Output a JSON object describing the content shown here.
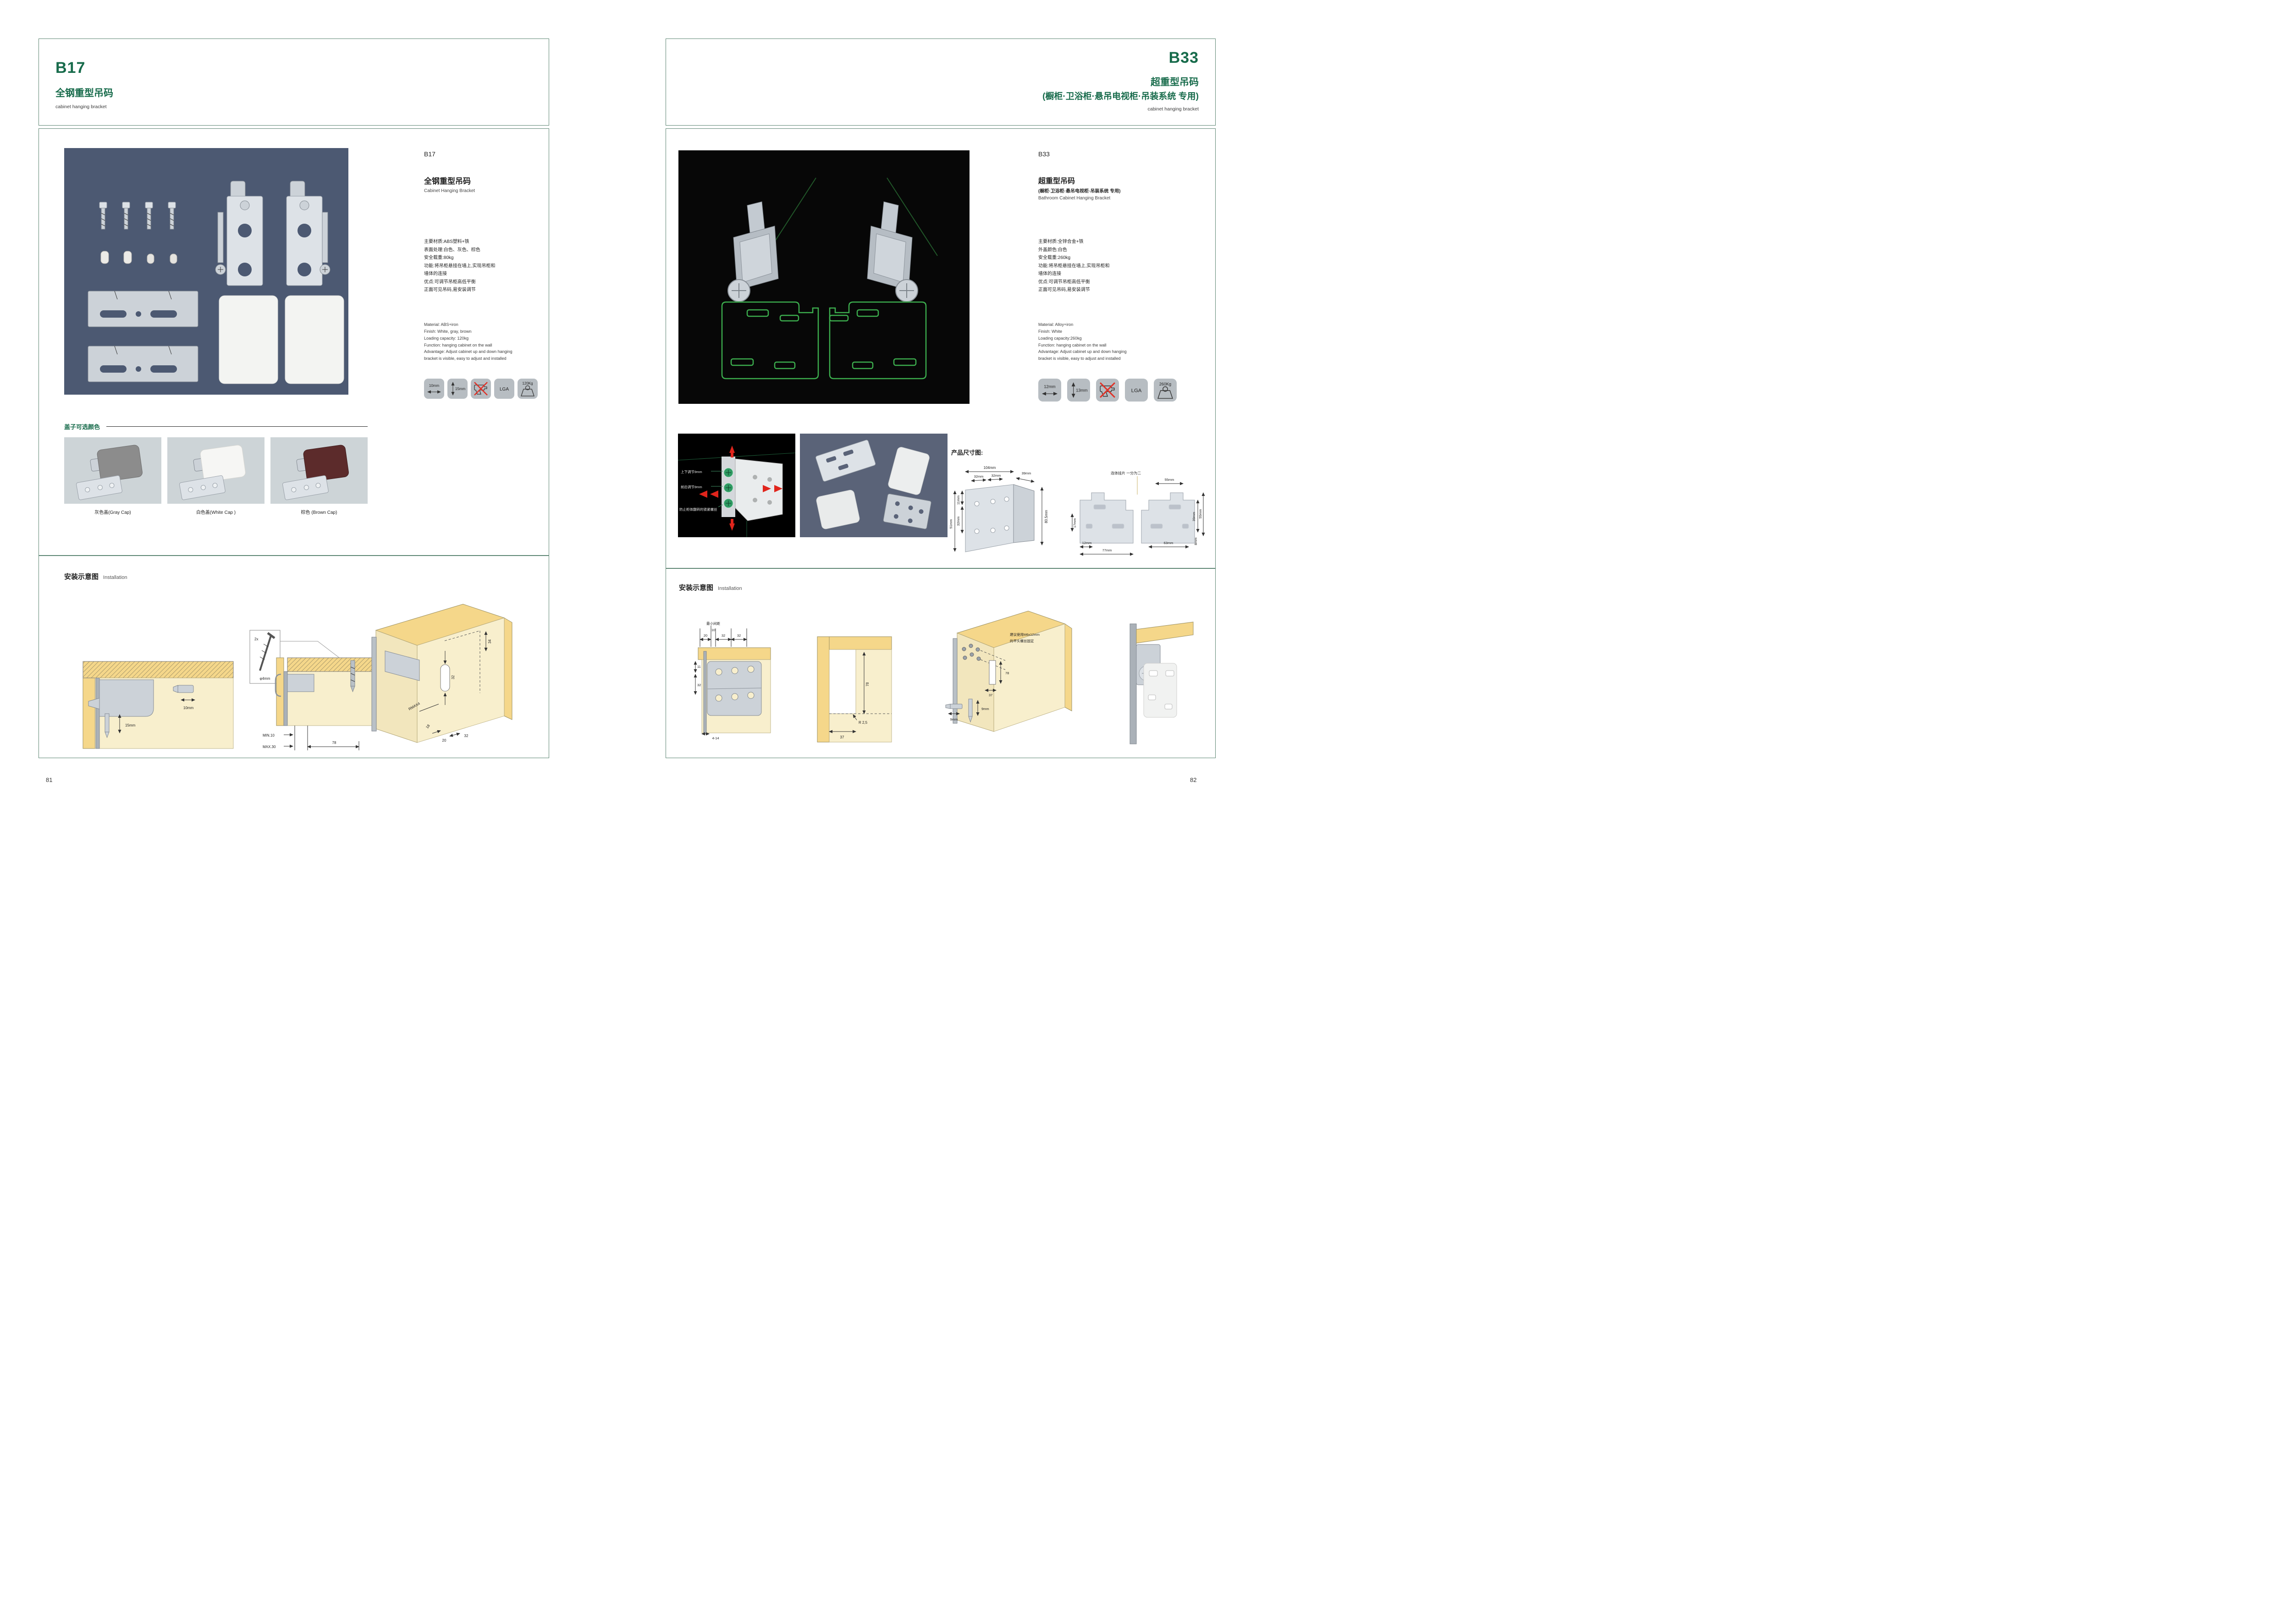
{
  "pages": {
    "left": {
      "page_number": "81",
      "header": {
        "code": "B17",
        "title_cn": "全钢重型吊码",
        "subtitle_en": "cabinet hanging bracket"
      },
      "product": {
        "code": "B17",
        "title_cn": "全钢重型吊码",
        "title_en": "Cabinet Hanging Bracket",
        "specs_cn": [
          "主要材质:ABS塑料+铁",
          "表面处理:白色、灰色、棕色",
          "安全载重:80kg",
          "功能:将吊柜悬挂在墙上,实现吊柜和",
          "墙体的连接",
          "优点:可调节吊柜高低平衡",
          "正面可见吊码,易安装调节"
        ],
        "specs_en": [
          "Material: ABS+iron",
          "Finish: White, gray, brown",
          "Loading capacity: 120kg",
          "Function: hanging cabinet on the wall",
          "Advantage: Adjust cabinet up and down hanging",
          "bracket is visible, easy to adjust and installed"
        ],
        "icons": {
          "width": "10mm",
          "height": "15mm",
          "no_drill": "no-drill-icon",
          "cert": "LGA",
          "load": "120Kg"
        }
      },
      "caps": {
        "section_title": "盖子可选颜色",
        "items": [
          {
            "label": "灰色盖(Gray Cap)"
          },
          {
            "label": "白色盖(White Cap )"
          },
          {
            "label": "棕色 (Brown Cap)"
          }
        ]
      },
      "installation": {
        "title_cn": "安装示意图",
        "title_en": "Installation",
        "d1": {
          "dim_w": "10mm",
          "dim_h": "15mm"
        },
        "d2": {
          "qty": "2x",
          "dia": "φ4mm",
          "t": "13",
          "min": "MIN.10",
          "max": "MAX.30",
          "depth": "78"
        },
        "d3": {
          "a": "34",
          "b": "32",
          "r": "RMAX4",
          "c": "18",
          "d": "20",
          "e": "32"
        }
      }
    },
    "right": {
      "page_number": "82",
      "header": {
        "code": "B33",
        "title_cn": "超重型吊码",
        "subtitle_cn": "(橱柜·卫浴柜·悬吊电视柜·吊装系统 专用)",
        "subtitle_en": "cabinet hanging bracket"
      },
      "product": {
        "code": "B33",
        "title_cn": "超重型吊码",
        "subtitle_cn": "(橱柜·卫浴柜·悬吊电视柜·吊装系统 专用)",
        "title_en": "Bathroom Cabinet Hanging Bracket",
        "specs_cn": [
          "主要材质:全锌合金+铁",
          "外盖颜色:白色",
          "安全载重:260kg",
          "功能:将吊柜悬挂在墙上,实现吊柜和",
          "墙体的连接",
          "优点:可调节吊柜高低平衡",
          "正面可见吊码,易安装调节"
        ],
        "specs_en": [
          "Material: Alloy+iron",
          "Finish: White",
          "Loading capacity:260kg",
          "Function: hanging cabinet on the wall",
          "Advantage: Adjust cabinet up and down hanging",
          "bracket is visible, easy to adjust and installed"
        ],
        "icons": {
          "width": "12mm",
          "height": "13mm",
          "no_drill": "no-drill-icon",
          "cert": "LGA",
          "load": "260Kg"
        }
      },
      "features": {
        "ann1": "上下调节9mm",
        "ann2": "前后调节9mm",
        "ann3": "防止柜体翻转的锁紧螺丝"
      },
      "dims": {
        "title": "产品尺寸图:",
        "bracket": {
          "w": "104mm",
          "p1": "32mm",
          "p2": "32mm",
          "d": "39mm",
          "e1": "11mm",
          "e2": "32mm",
          "e3": "51mm",
          "h": "80.5mm"
        },
        "plate": {
          "note": "连体挂片 一分为二",
          "top": "55mm",
          "left": "17mm",
          "b1": "12mm",
          "b2": "77mm",
          "b3": "63mm",
          "r1": "39mm",
          "r2": "55mm",
          "r3": "8mm"
        }
      },
      "installation": {
        "title_cn": "安装示意图",
        "title_en": "Installation",
        "d1": {
          "note": "最小间距",
          "a": "20",
          "b": "10",
          "c": "32",
          "d": "32",
          "e": "11",
          "f": "32",
          "g": "4-14"
        },
        "d2": {
          "a": "78",
          "b": "R 2,5",
          "c": "37"
        },
        "d3": {
          "note1": "建议使用M6x12mm",
          "note2": "的平头螺丝固定",
          "a": "78",
          "b": "37",
          "c": "9mm",
          "d": "9mm"
        }
      }
    }
  }
}
